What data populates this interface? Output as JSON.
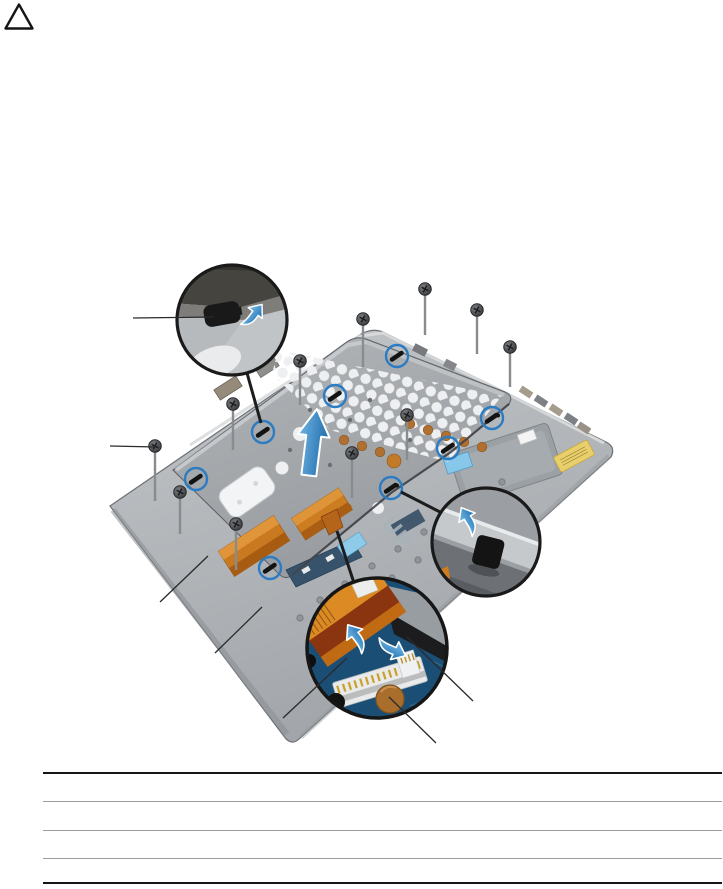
{
  "page": {
    "caution_icon": "warning-triangle",
    "table": {
      "rows": [
        "",
        "",
        "",
        ""
      ]
    }
  },
  "figure": {
    "up_label": "UP",
    "counts": {
      "screws": 11,
      "tab_callouts": 8,
      "zoom_insets": 3
    },
    "insets": [
      "shield-tab-zoom",
      "palmrest-tab-zoom",
      "keyboard-cable-connector-zoom"
    ],
    "palette": {
      "accent_blue": "#2b7cc2",
      "palmrest_gray": "#aeb2b6",
      "shield_gray": "#a4a8ab",
      "ribbon_orange": "#cf7a1d",
      "ribbon_dark_band": "#8a3510",
      "pcb_blue": "#1b4e74",
      "copper_pad": "#a96e2c",
      "sticker_yellow": "#e9cf6b"
    }
  }
}
